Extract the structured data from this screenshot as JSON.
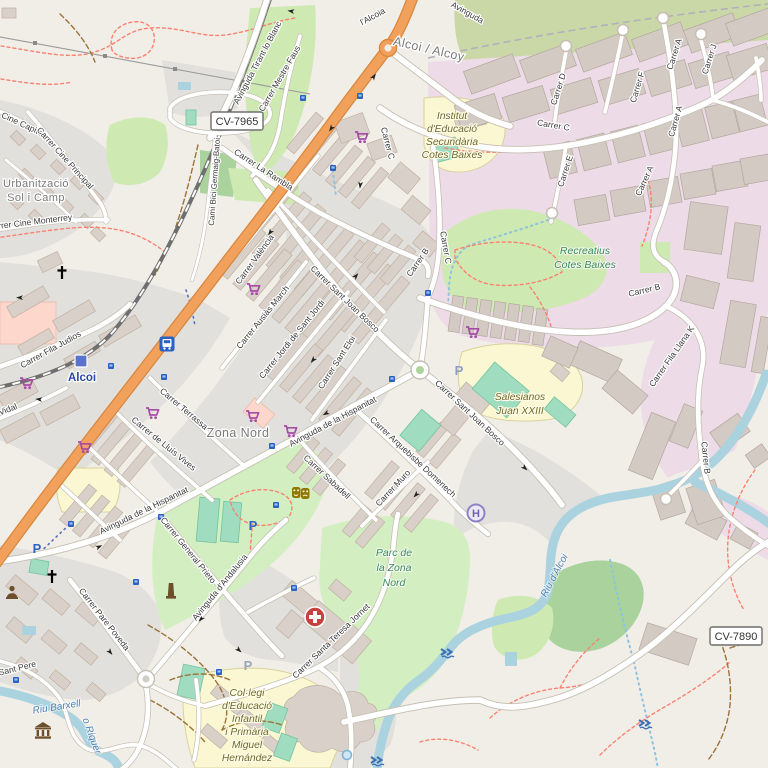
{
  "map": {
    "style": "openstreetmap-carto",
    "city": "Alcoi / Alcoy"
  },
  "badges": {
    "cv7965": "CV-7965",
    "cv7890": "CV-7890"
  },
  "places": {
    "city": "Alcoi / Alcoy",
    "urbanitzacio_line1": "Urbanització",
    "urbanitzacio_line2": "Sol i Camp",
    "zona_nord": "Zona Nord",
    "station": "Alcoi",
    "trunk_name": "l'Alcoia"
  },
  "streets": {
    "tirant": "Avinguda Tirant lo Blanc",
    "mestre_faus": "Carrer Mestre Faus",
    "cami_bici": "Camí Bici Germaig-Batoi",
    "la_rambla": "Carrer La Rambla",
    "valencia": "Carrer València",
    "cine_capitol": "Cine Capitol",
    "cine_principal": "Carrer Cine Principal",
    "cine_monterrey": "Carrer Cine Monterrey",
    "fila_judios": "Carrer Fila Judios",
    "vidal": "Vidal",
    "terrassa": "Carrer Terrassa",
    "lluis_vives": "Carrer de Lluís Vives",
    "ausias_march": "Carrer Ausiàs March",
    "jordi_sant_jordi": "Carrer Jordi de Sant Jordi",
    "sant_eloi": "Carrer Sant Eloi",
    "sant_joan_bosco": "Carrer Sant Joan Bosco",
    "hispanitat": "Avinguda de la Hispanitat",
    "arquebisbe": "Carrer Arquebisbe Domenech",
    "sabadell": "Carrer Sabadell",
    "muro": "Carrer Muro",
    "general_prieto": "Carrer General Prieto",
    "andalusia": "Avinguda d'Andalusia",
    "pare_poveda": "Carrer Pare Poveda",
    "sant_pere": "Sant Pere",
    "santa_teresa": "Carrer Santa Teresa Jornet",
    "carrer_a": "Carrer A",
    "carrer_b": "Carrer B",
    "carrer_c": "Carrer C",
    "carrer_d": "Carrer D",
    "carrer_e": "Carrer E",
    "carrer_f": "Carrer F",
    "carrer_j": "Carrer J",
    "fila_llana": "Carrer Fila Llana K",
    "avinguda_partial": "Avinguda"
  },
  "areas": {
    "institut": [
      "Institut",
      "d'Educació",
      "Secundària",
      "Cotes Baixes"
    ],
    "recreatius": [
      "Recreatius",
      "Cotes Baixes"
    ],
    "salesianos": [
      "Salesianos",
      "Juan XXIII"
    ],
    "parc_zona_nord": [
      "Parc de",
      "la Zona",
      "Nord"
    ],
    "colegi": [
      "Col·legi",
      "d'Educació",
      "Infantil",
      "i Primària",
      "Miguel",
      "Hernández"
    ]
  },
  "water": {
    "riu_barxell": "Riu Barxell",
    "o_riquer": "o Riquer",
    "riu_alcoi": "Riu d'Alcoi"
  },
  "icons": {
    "parking_letter": "P",
    "helipad_letter": "H",
    "supermarket": "shopping-cart",
    "bus_stop": "small-blue-square",
    "station": "railway-station-square",
    "bus_station": "bus-glyph",
    "church": "christian-cross",
    "clinic": "red-circle-white-cross",
    "theatre": "comedy-masks",
    "museum": "classical-building",
    "monument": "obelisk",
    "memorial": "bust",
    "ford": "blue-double-chevron",
    "spring": "blue-circle"
  },
  "colors": {
    "trunk_road": "#f2a15c",
    "water": "#aad3df",
    "park": "#d3eec0",
    "industrial": "#eddbe7",
    "residential": "#e2e0dc",
    "retail": "#fdd7cc",
    "school": "#fbf7d2",
    "building": "#d9d0c9",
    "footpath": "#fb8170",
    "track": "#9c7338",
    "station_label": "#2b47a3",
    "park_label": "#3f8a63",
    "school_label": "#6e682b",
    "water_label": "#4d80b3",
    "supermarket_icon": "#a64ca6"
  }
}
